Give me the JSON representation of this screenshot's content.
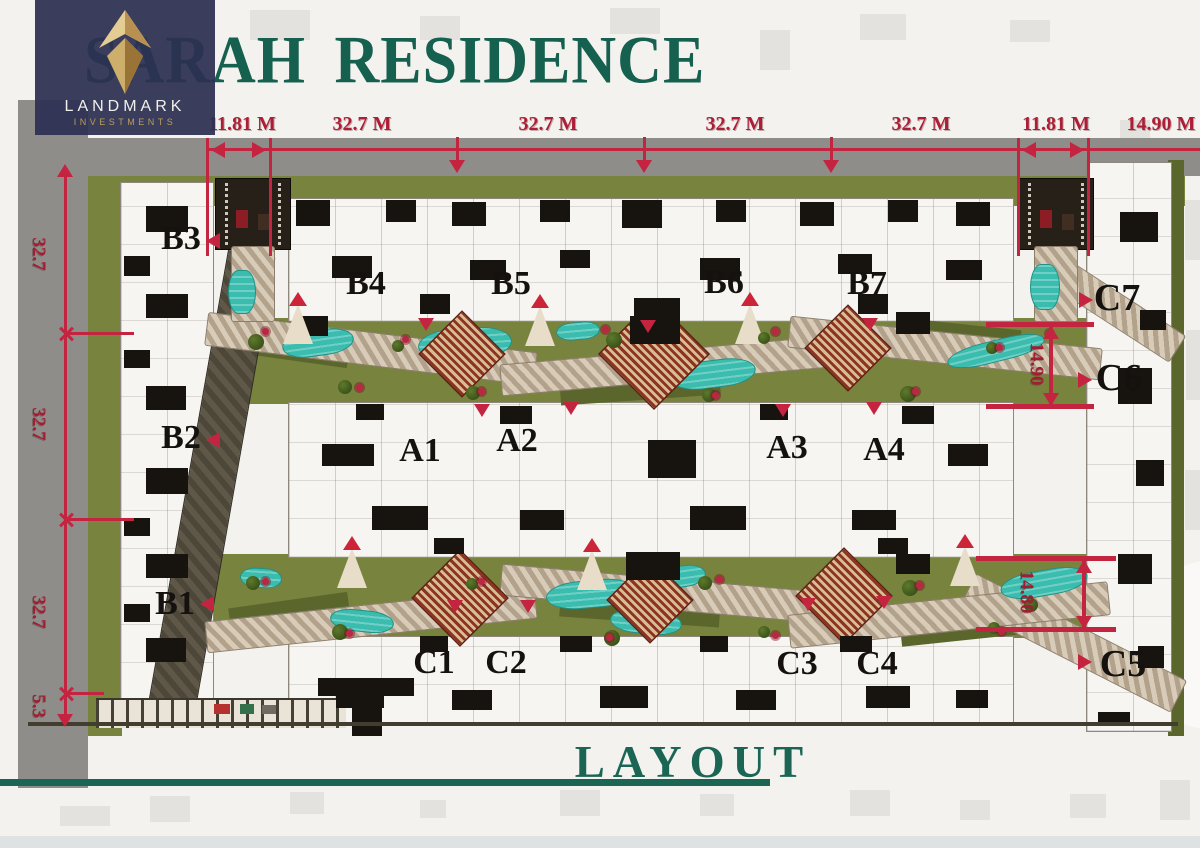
{
  "logo": {
    "name": "LANDMARK",
    "subtitle": "INVESTMENTS"
  },
  "title": "SARAH RESIDENCE",
  "caption": "LAYOUT",
  "dims_top": [
    "11.81 M",
    "32.7 M",
    "32.7 M",
    "32.7 M",
    "32.7 M",
    "11.81 M",
    "14.90 M"
  ],
  "dims_left": [
    "32.7",
    "32.7",
    "32.7",
    "5.3"
  ],
  "dims_inner": [
    "14.90",
    "14.80"
  ],
  "buildings": [
    "B3",
    "B4",
    "B5",
    "B6",
    "B7",
    "C7",
    "C6",
    "B2",
    "A1",
    "A2",
    "A3",
    "A4",
    "B1",
    "C1",
    "C2",
    "C3",
    "C4",
    "C5"
  ],
  "colors": {
    "brand_navy": "#2c2f52",
    "brand_gold": "#c8a55e",
    "title_teal": "#15604f",
    "dimension_red": "#c32440",
    "pool_teal": "#3abcae",
    "landscape_olive": "#78833e"
  }
}
